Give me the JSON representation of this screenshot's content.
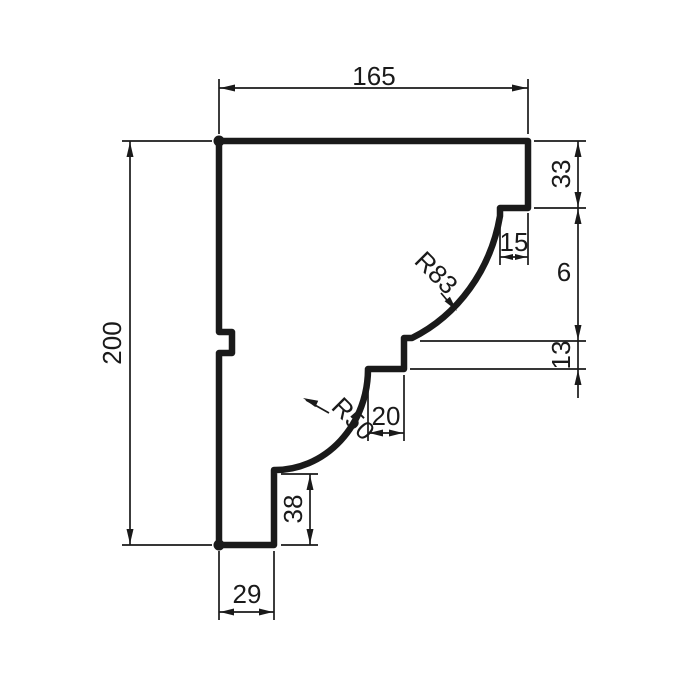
{
  "drawing": {
    "type": "technical-profile-drawing",
    "dimensions": {
      "overall_width": "165",
      "overall_height": "200",
      "right_top_height": "33",
      "step_width": "15",
      "right_mid_height": "6",
      "band_height": "13",
      "band_width": "20",
      "lower_face_height": "38",
      "bottom_width": "29"
    },
    "radii": {
      "upper": "R83",
      "lower": "R50"
    }
  },
  "colors": {
    "line": "#1a1a1a",
    "background": "#ffffff"
  }
}
